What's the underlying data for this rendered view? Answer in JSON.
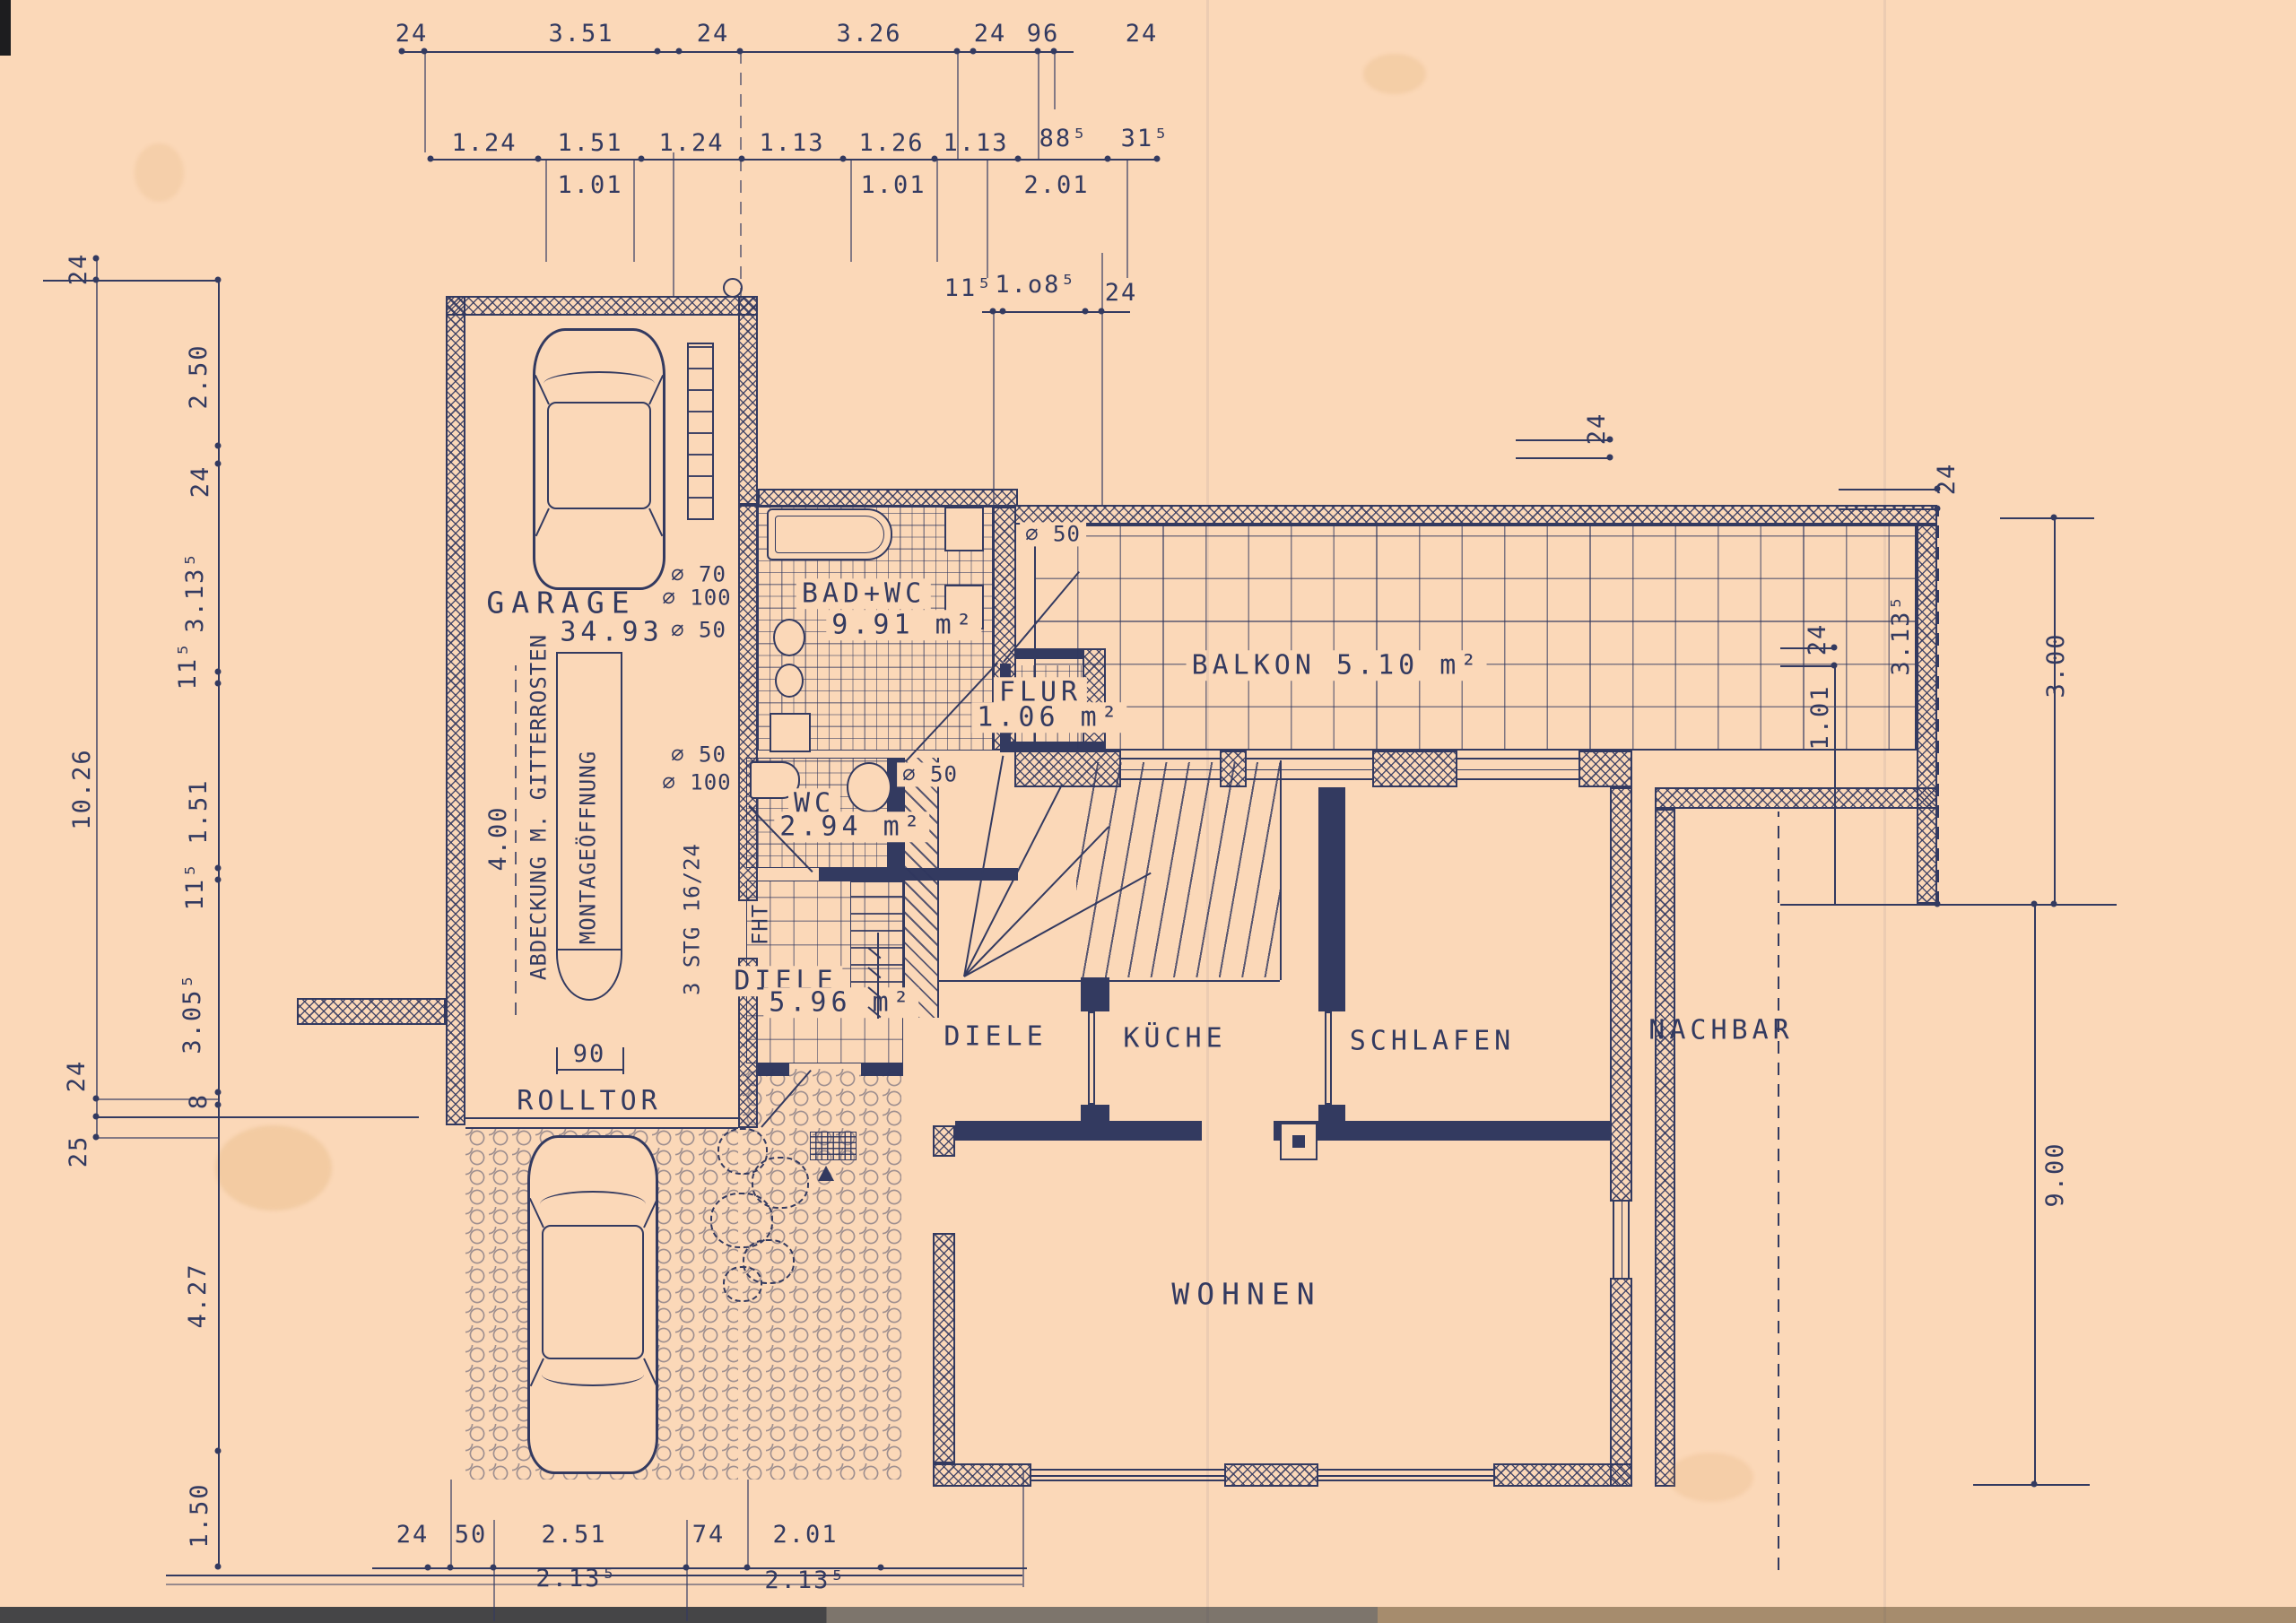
{
  "colors": {
    "paper": "#fbd8b8",
    "ink": "#333a60",
    "scan_dark": "#454547",
    "scan_mid": "#7d756c",
    "scan_light": "#a68c6d"
  },
  "dims": {
    "top1": [
      "24",
      "3.51",
      "24",
      "3.26",
      "24",
      "96",
      "24"
    ],
    "top2": [
      "1.24",
      "1.51",
      "1.24",
      "1.13",
      "1.26",
      "1.13",
      "88⁵",
      "31⁵"
    ],
    "top3": [
      "1.01",
      "1.01",
      "2.01"
    ],
    "top4": [
      "11⁵",
      "1.o8⁵",
      "24"
    ],
    "left_outer": [
      "24",
      "10.26",
      "24",
      "25"
    ],
    "left_inner": [
      "2.50",
      "24",
      "3.13⁵",
      "11⁵",
      "1.51",
      "11⁵",
      "3.05⁵",
      "8",
      "4.27",
      "1.50"
    ],
    "right": [
      "24",
      "24",
      "3.13⁵",
      "3.00",
      "24",
      "1.01",
      "9.00"
    ],
    "bottom1": [
      "24",
      "50",
      "2.51",
      "74",
      "2.01"
    ],
    "bottom2": [
      "2.13⁵",
      "2.13⁵"
    ],
    "garage_width": "90",
    "garage_length": "4.00"
  },
  "rooms": {
    "garage": {
      "name": "GARAGE",
      "area": "34.93"
    },
    "bad_wc": {
      "name": "BAD+WC",
      "area": "9.91 m²"
    },
    "wc": {
      "name": "WC",
      "area": "2.94 m²"
    },
    "flur": {
      "name": "FLUR",
      "area": "1.06 m²"
    },
    "balkon": {
      "name": "BALKON 5.10 m²"
    },
    "diele_hall": {
      "name": "DIELE",
      "area": "5.96 m²"
    },
    "diele": {
      "name": "DIELE"
    },
    "kueche": {
      "name": "KÜCHE"
    },
    "schlafen": {
      "name": "SCHLAFEN"
    },
    "wohnen": {
      "name": "WOHNEN"
    },
    "nachbar": {
      "name": "NACHBAR"
    }
  },
  "annotations": {
    "rolltor": "ROLLTOR",
    "abdeckung": "ABDECKUNG M. GITTERROSTEN",
    "montage": "MONTAGEÖFFNUNG",
    "treppe": "3 STG 16/24",
    "fht": "FHT"
  },
  "pipes": [
    "⌀ 70",
    "⌀ 100",
    "⌀ 50",
    "⌀ 50",
    "⌀ 100",
    "⌀ 50",
    "⌀ 50"
  ]
}
